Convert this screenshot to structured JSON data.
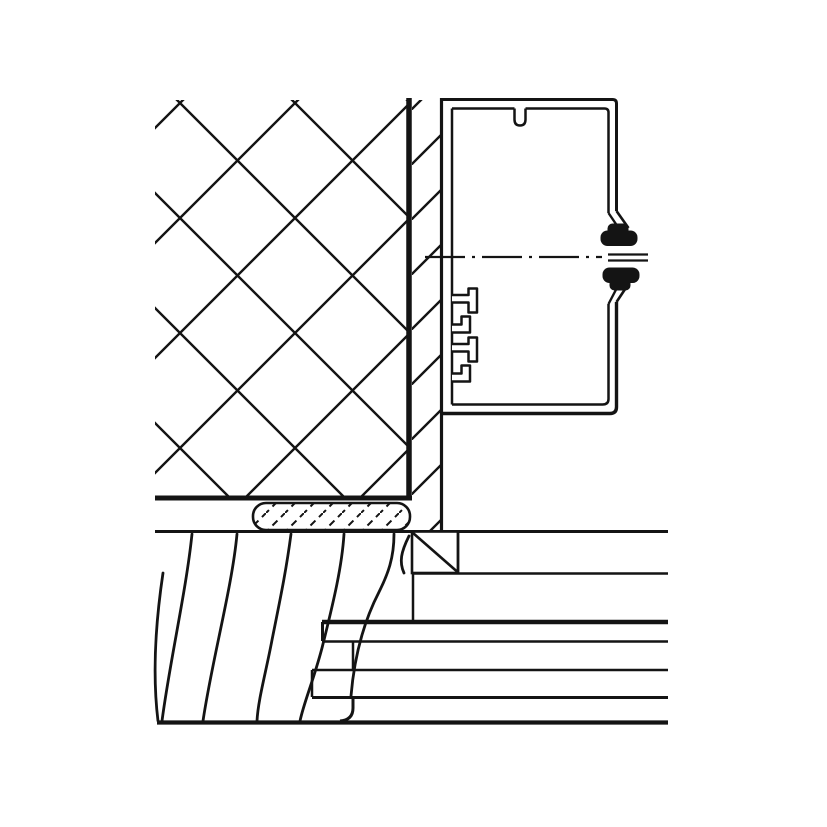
{
  "figure": {
    "type": "technical-detail-drawing",
    "description": "Sectional installation detail: wall-mounted cable trunking profile on a hatched masonry wall with plaster layer, above a timber sill and layered floorboard construction with sealant joint",
    "colors": {
      "ink": "#141414",
      "paper": "#ffffff"
    },
    "components": [
      {
        "name": "masonry-wall",
        "rendering": "diamond cross-hatch"
      },
      {
        "name": "plaster-layer",
        "rendering": "single diagonal hatch band"
      },
      {
        "name": "cable-trunking-profile",
        "rendering": "double-line rectangular duct with top slot, two divider rails, cover opening"
      },
      {
        "name": "cover-retaining-clips",
        "rendering": "two solid black clip symbols"
      },
      {
        "name": "symmetry-centerline",
        "rendering": "dash-dot line"
      },
      {
        "name": "sealant-joint",
        "rendering": "rounded strip with dashed diagonal hatch"
      },
      {
        "name": "timber-sill",
        "rendering": "wood grain curves"
      },
      {
        "name": "batten-block",
        "rendering": "square with single diagonal"
      },
      {
        "name": "floorboard-layers",
        "rendering": "stepped interlocking horizontal boards"
      }
    ]
  }
}
